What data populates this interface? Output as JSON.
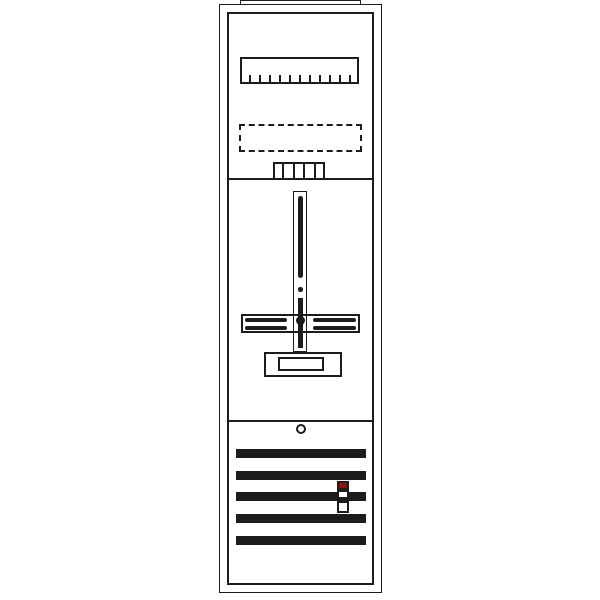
{
  "diagram": {
    "colors": {
      "line": "#1c1c1c",
      "background": "#ffffff",
      "indicator": "#8e1010"
    },
    "terminal_strip": {
      "ticks": 11
    },
    "comb_rail": {
      "cells": 5
    },
    "busbars": {
      "count": 5
    }
  }
}
